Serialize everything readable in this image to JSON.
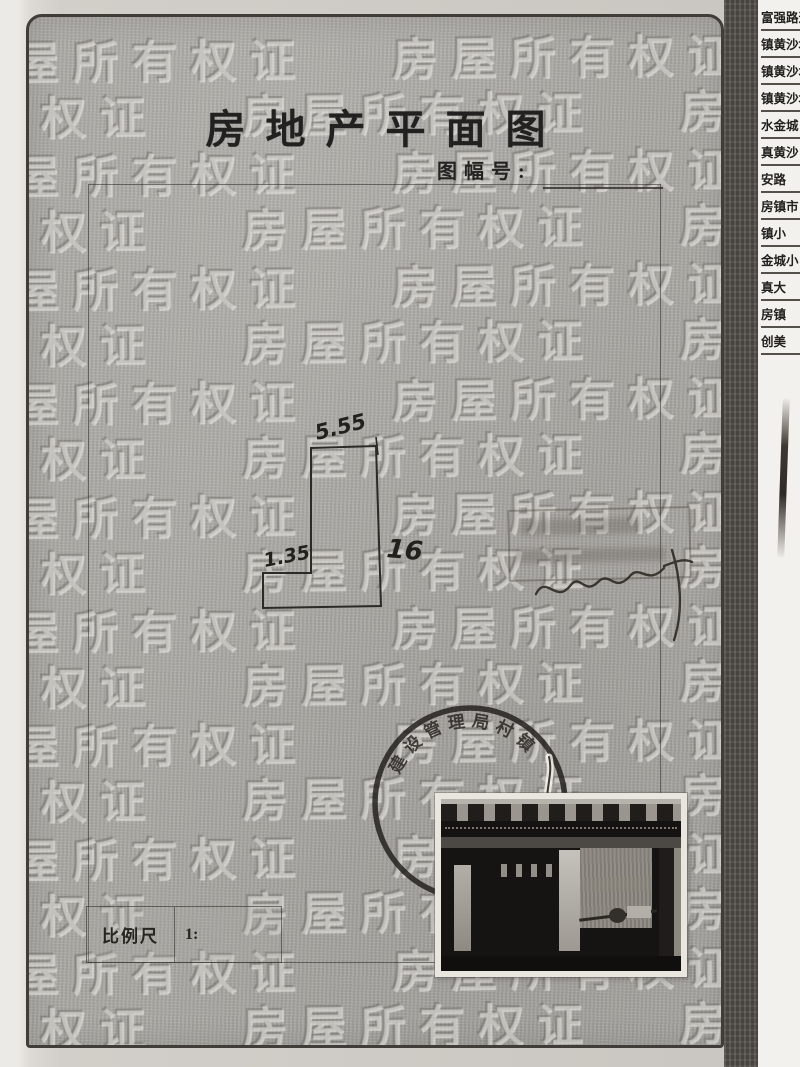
{
  "document": {
    "title": "房地产平面图",
    "sheet_number_label": "图幅号:",
    "sheet_number_value": "",
    "scale_label": "比例尺",
    "scale_value": "1:",
    "watermark_text": "房屋所有权证",
    "watermark_rows": 18
  },
  "floor_plan": {
    "dim_top": "5.55",
    "dim_left_step": "1.35",
    "dim_right": "16"
  },
  "stamps": {
    "round_stamp_arc_text": "建设管理局村镇"
  },
  "side_strip": {
    "rows": [
      "富强路道",
      "镇黄沙坨",
      "镇黄沙坨",
      "镇黄沙坨",
      "水金城",
      "真黄沙",
      "安路",
      "房镇市",
      "镇小",
      "金城小",
      "真大",
      "房镇",
      "创美"
    ]
  },
  "colors": {
    "page_gray": "#acaaa5",
    "ink": "#23211e",
    "strip_bg": "#f3f1ed",
    "scan_edge": "#56524c"
  }
}
